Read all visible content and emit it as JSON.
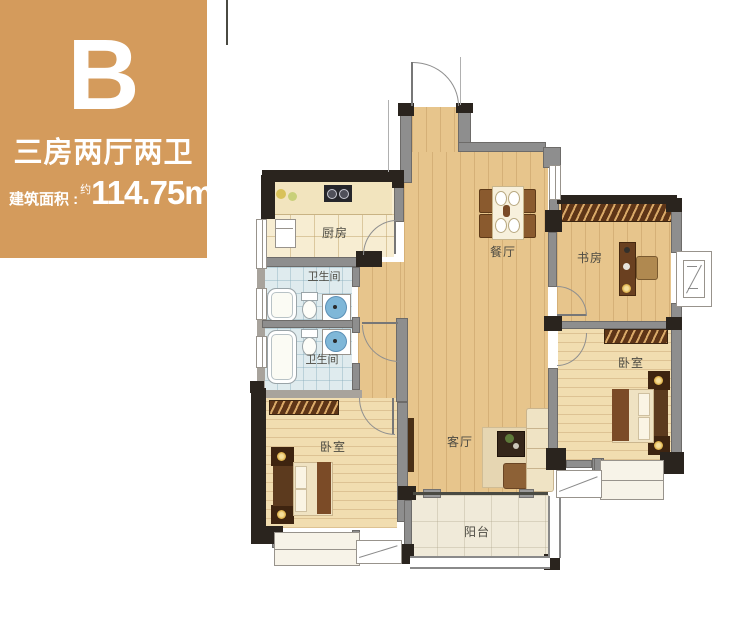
{
  "panel": {
    "unit": "B",
    "title": "三房两厅两卫",
    "area_label": "建筑面积 :",
    "area_approx": "约",
    "area_value": "114.75m",
    "area_sup": "2",
    "bg_color": "#D49B5C"
  },
  "rooms": {
    "kitchen": "厨房",
    "bath_top": "卫生间",
    "bath_bottom": "卫生间",
    "dining": "餐厅",
    "study": "书房",
    "bedroom_right": "卧室",
    "bedroom_left": "卧室",
    "living": "客厅",
    "balcony": "阳台"
  },
  "colors": {
    "accent_orange": "#D49B5C",
    "wall_dark": "#2A241E",
    "wall_gray": "#8E8E8E",
    "wood_floor": "#E7C58C",
    "bedroom_floor": "#F1DDB0",
    "bath_tile": "#DFEBEE"
  }
}
